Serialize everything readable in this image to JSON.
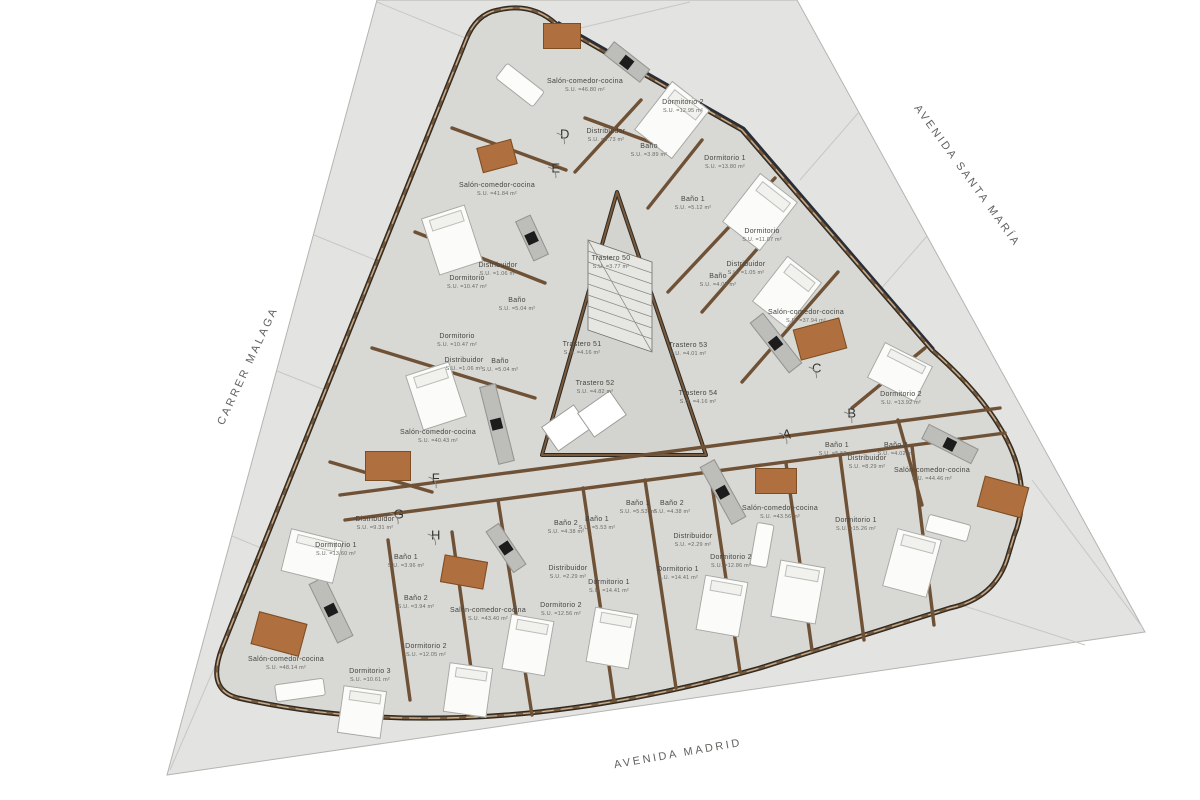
{
  "plan": {
    "streets": [
      {
        "name": "CARRER MALAGA",
        "x": 248,
        "y": 366,
        "r": -65
      },
      {
        "name": "AVENIDA SANTA MARÍA",
        "x": 967,
        "y": 176,
        "r": 54
      },
      {
        "name": "AVENIDA MADRID",
        "x": 678,
        "y": 754,
        "r": -10
      }
    ],
    "markers": [
      {
        "letter": "A",
        "x": 787,
        "y": 434
      },
      {
        "letter": "B",
        "x": 852,
        "y": 413
      },
      {
        "letter": "C",
        "x": 817,
        "y": 368
      },
      {
        "letter": "D",
        "x": 565,
        "y": 134
      },
      {
        "letter": "E",
        "x": 556,
        "y": 168
      },
      {
        "letter": "F",
        "x": 436,
        "y": 478
      },
      {
        "letter": "G",
        "x": 399,
        "y": 514
      },
      {
        "letter": "H",
        "x": 436,
        "y": 535
      }
    ],
    "rooms": [
      {
        "name": "Salón-comedor-cocina",
        "area": "S.U. =46.80 m²",
        "x": 585,
        "y": 86
      },
      {
        "name": "Dormitorio 2",
        "area": "S.U. =12.95 m²",
        "x": 683,
        "y": 107
      },
      {
        "name": "Distribuidor",
        "area": "S.U. =3.73 m²",
        "x": 606,
        "y": 136
      },
      {
        "name": "Baño",
        "area": "S.U. =3.89 m²",
        "x": 649,
        "y": 151
      },
      {
        "name": "Dormitorio 1",
        "area": "S.U. =13.80 m²",
        "x": 725,
        "y": 163
      },
      {
        "name": "Baño 1",
        "area": "S.U. =5.12 m²",
        "x": 693,
        "y": 204
      },
      {
        "name": "Dormitorio",
        "area": "S.U. =11.07 m²",
        "x": 762,
        "y": 236
      },
      {
        "name": "Distribuidor",
        "area": "S.U. =1.05 m²",
        "x": 746,
        "y": 269
      },
      {
        "name": "Baño",
        "area": "S.U. =4.05 m²",
        "x": 718,
        "y": 281
      },
      {
        "name": "Salón-comedor-cocina",
        "area": "S.U. =37.94 m²",
        "x": 806,
        "y": 317
      },
      {
        "name": "Salón-comedor-cocina",
        "area": "S.U. =41.84 m²",
        "x": 497,
        "y": 190
      },
      {
        "name": "Distribuidor",
        "area": "S.U. =1.06 m²",
        "x": 498,
        "y": 270
      },
      {
        "name": "Dormitorio",
        "area": "S.U. =10.47 m²",
        "x": 467,
        "y": 283
      },
      {
        "name": "Baño",
        "area": "S.U. =5.04 m²",
        "x": 517,
        "y": 305
      },
      {
        "name": "Dormitorio",
        "area": "S.U. =10.47 m²",
        "x": 457,
        "y": 341
      },
      {
        "name": "Distribuidor",
        "area": "S.U. =1.06 m²",
        "x": 464,
        "y": 365
      },
      {
        "name": "Baño",
        "area": "S.U. =5.04 m²",
        "x": 500,
        "y": 366
      },
      {
        "name": "Salón-comedor-cocina",
        "area": "S.U. =40.43 m²",
        "x": 438,
        "y": 437
      },
      {
        "name": "Trastero 50",
        "area": "S.U. =3.77 m²",
        "x": 611,
        "y": 263
      },
      {
        "name": "Trastero 51",
        "area": "S.U. =4.16 m²",
        "x": 582,
        "y": 349
      },
      {
        "name": "Trastero 52",
        "area": "S.U. =4.82 m²",
        "x": 595,
        "y": 388
      },
      {
        "name": "Trastero 53",
        "area": "S.U. =4.01 m²",
        "x": 688,
        "y": 350
      },
      {
        "name": "Trastero 54",
        "area": "S.U. =4.16 m²",
        "x": 698,
        "y": 398
      },
      {
        "name": "Dormitorio 2",
        "area": "S.U. =13.92 m²",
        "x": 901,
        "y": 399
      },
      {
        "name": "Baño 1",
        "area": "S.U. =5.52 m²",
        "x": 837,
        "y": 450
      },
      {
        "name": "Baño 2",
        "area": "S.U. =4.02 m²",
        "x": 896,
        "y": 450
      },
      {
        "name": "Distribuidor",
        "area": "S.U. =8.29 m²",
        "x": 867,
        "y": 463
      },
      {
        "name": "Salón-comedor-cocina",
        "area": "S.U. =44.46 m²",
        "x": 932,
        "y": 475
      },
      {
        "name": "Dormitorio 1",
        "area": "S.U. =15.26 m²",
        "x": 856,
        "y": 525
      },
      {
        "name": "Baño 1",
        "area": "S.U. =5.53 m²",
        "x": 638,
        "y": 508
      },
      {
        "name": "Baño 2",
        "area": "S.U. =4.38 m²",
        "x": 672,
        "y": 508
      },
      {
        "name": "Distribuidor",
        "area": "S.U. =2.29 m²",
        "x": 693,
        "y": 541
      },
      {
        "name": "Salón-comedor-cocina",
        "area": "S.U. =43.56 m²",
        "x": 780,
        "y": 513
      },
      {
        "name": "Dormitorio 2",
        "area": "S.U. =12.86 m²",
        "x": 731,
        "y": 562
      },
      {
        "name": "Dormitorio 1",
        "area": "S.U. =14.41 m²",
        "x": 678,
        "y": 574
      },
      {
        "name": "Baño 2",
        "area": "S.U. =4.38 m²",
        "x": 566,
        "y": 528
      },
      {
        "name": "Baño 1",
        "area": "S.U. =5.53 m²",
        "x": 597,
        "y": 524
      },
      {
        "name": "Distribuidor",
        "area": "S.U. =2.29 m²",
        "x": 568,
        "y": 573
      },
      {
        "name": "Dormitorio 1",
        "area": "S.U. =14.41 m²",
        "x": 609,
        "y": 587
      },
      {
        "name": "Dormitorio 2",
        "area": "S.U. =12.56 m²",
        "x": 561,
        "y": 610
      },
      {
        "name": "Salón-comedor-cocina",
        "area": "S.U. =43.40 m²",
        "x": 488,
        "y": 615
      },
      {
        "name": "Distribuidor",
        "area": "S.U. =9.31 m²",
        "x": 375,
        "y": 524
      },
      {
        "name": "Dormitorio 1",
        "area": "S.U. =13.60 m²",
        "x": 336,
        "y": 550
      },
      {
        "name": "Baño 1",
        "area": "S.U. =3.96 m²",
        "x": 406,
        "y": 562
      },
      {
        "name": "Baño 2",
        "area": "S.U. =3.94 m²",
        "x": 416,
        "y": 603
      },
      {
        "name": "Dormitorio 2",
        "area": "S.U. =12.05 m²",
        "x": 426,
        "y": 651
      },
      {
        "name": "Dormitorio 3",
        "area": "S.U. =10.61 m²",
        "x": 370,
        "y": 676
      },
      {
        "name": "Salón-comedor-cocina",
        "area": "S.U. =48.14 m²",
        "x": 286,
        "y": 664
      }
    ],
    "furniture": [
      {
        "kind": "table",
        "x": 562,
        "y": 36,
        "w": 38,
        "h": 26,
        "r": 0
      },
      {
        "kind": "table",
        "x": 497,
        "y": 156,
        "w": 36,
        "h": 26,
        "r": -15
      },
      {
        "kind": "table",
        "x": 820,
        "y": 339,
        "w": 48,
        "h": 32,
        "r": -15
      },
      {
        "kind": "table",
        "x": 1003,
        "y": 497,
        "w": 46,
        "h": 32,
        "r": 15
      },
      {
        "kind": "table",
        "x": 776,
        "y": 481,
        "w": 42,
        "h": 26,
        "r": 0
      },
      {
        "kind": "table",
        "x": 464,
        "y": 572,
        "w": 44,
        "h": 28,
        "r": 10
      },
      {
        "kind": "table",
        "x": 279,
        "y": 634,
        "w": 50,
        "h": 34,
        "r": 15
      },
      {
        "kind": "table",
        "x": 388,
        "y": 466,
        "w": 46,
        "h": 30,
        "r": 0
      },
      {
        "kind": "island",
        "x": 627,
        "y": 62,
        "w": 46,
        "h": 17,
        "r": 38
      },
      {
        "kind": "island",
        "x": 532,
        "y": 238,
        "w": 44,
        "h": 17,
        "r": 65
      },
      {
        "kind": "island",
        "x": 497,
        "y": 424,
        "w": 80,
        "h": 17,
        "r": 76
      },
      {
        "kind": "island",
        "x": 776,
        "y": 343,
        "w": 64,
        "h": 17,
        "r": 52
      },
      {
        "kind": "island",
        "x": 950,
        "y": 444,
        "w": 56,
        "h": 17,
        "r": 27
      },
      {
        "kind": "island",
        "x": 723,
        "y": 492,
        "w": 66,
        "h": 17,
        "r": 61
      },
      {
        "kind": "island",
        "x": 506,
        "y": 548,
        "w": 50,
        "h": 16,
        "r": 56
      },
      {
        "kind": "island",
        "x": 331,
        "y": 610,
        "w": 66,
        "h": 18,
        "r": 64
      },
      {
        "kind": "bed",
        "x": 452,
        "y": 240,
        "w": 46,
        "h": 60,
        "r": -18
      },
      {
        "kind": "bed",
        "x": 436,
        "y": 396,
        "w": 46,
        "h": 58,
        "r": -18
      },
      {
        "kind": "bed",
        "x": 672,
        "y": 120,
        "w": 48,
        "h": 62,
        "r": 38
      },
      {
        "kind": "bed",
        "x": 760,
        "y": 212,
        "w": 48,
        "h": 62,
        "r": 38
      },
      {
        "kind": "bed",
        "x": 787,
        "y": 292,
        "w": 44,
        "h": 58,
        "r": 38
      },
      {
        "kind": "bed",
        "x": 900,
        "y": 372,
        "w": 54,
        "h": 40,
        "r": 27
      },
      {
        "kind": "bed",
        "x": 912,
        "y": 563,
        "w": 46,
        "h": 60,
        "r": 15
      },
      {
        "kind": "bed",
        "x": 798,
        "y": 592,
        "w": 46,
        "h": 58,
        "r": 10
      },
      {
        "kind": "bed",
        "x": 722,
        "y": 606,
        "w": 44,
        "h": 56,
        "r": 10
      },
      {
        "kind": "bed",
        "x": 528,
        "y": 645,
        "w": 44,
        "h": 56,
        "r": 10
      },
      {
        "kind": "bed",
        "x": 612,
        "y": 638,
        "w": 44,
        "h": 56,
        "r": 10
      },
      {
        "kind": "bed",
        "x": 312,
        "y": 556,
        "w": 54,
        "h": 44,
        "r": 14
      },
      {
        "kind": "bed",
        "x": 362,
        "y": 712,
        "w": 44,
        "h": 48,
        "r": 8
      },
      {
        "kind": "bed",
        "x": 468,
        "y": 690,
        "w": 44,
        "h": 50,
        "r": 8
      },
      {
        "kind": "sofa",
        "x": 520,
        "y": 85,
        "w": 48,
        "h": 20,
        "r": 38
      },
      {
        "kind": "sofa",
        "x": 948,
        "y": 528,
        "w": 44,
        "h": 18,
        "r": 15
      },
      {
        "kind": "sofa",
        "x": 300,
        "y": 690,
        "w": 50,
        "h": 18,
        "r": -8
      },
      {
        "kind": "sofa",
        "x": 762,
        "y": 545,
        "w": 18,
        "h": 44,
        "r": 10
      },
      {
        "kind": "box",
        "x": 566,
        "y": 428,
        "w": 30,
        "h": 40,
        "r": 55
      },
      {
        "kind": "box",
        "x": 602,
        "y": 414,
        "w": 30,
        "h": 40,
        "r": 55
      }
    ],
    "colors": {
      "site": "#e3e3e1",
      "building": "#d8d8d5",
      "wall_brown": "#7a5a3c",
      "wall_dark": "#2e2a22",
      "glazing_dark": "#272e3a",
      "table": "#b06f3e",
      "island": "#bdbdba",
      "cooktop": "#1c1c1c",
      "label_text": "#45443f",
      "street_text": "#62615c"
    }
  }
}
